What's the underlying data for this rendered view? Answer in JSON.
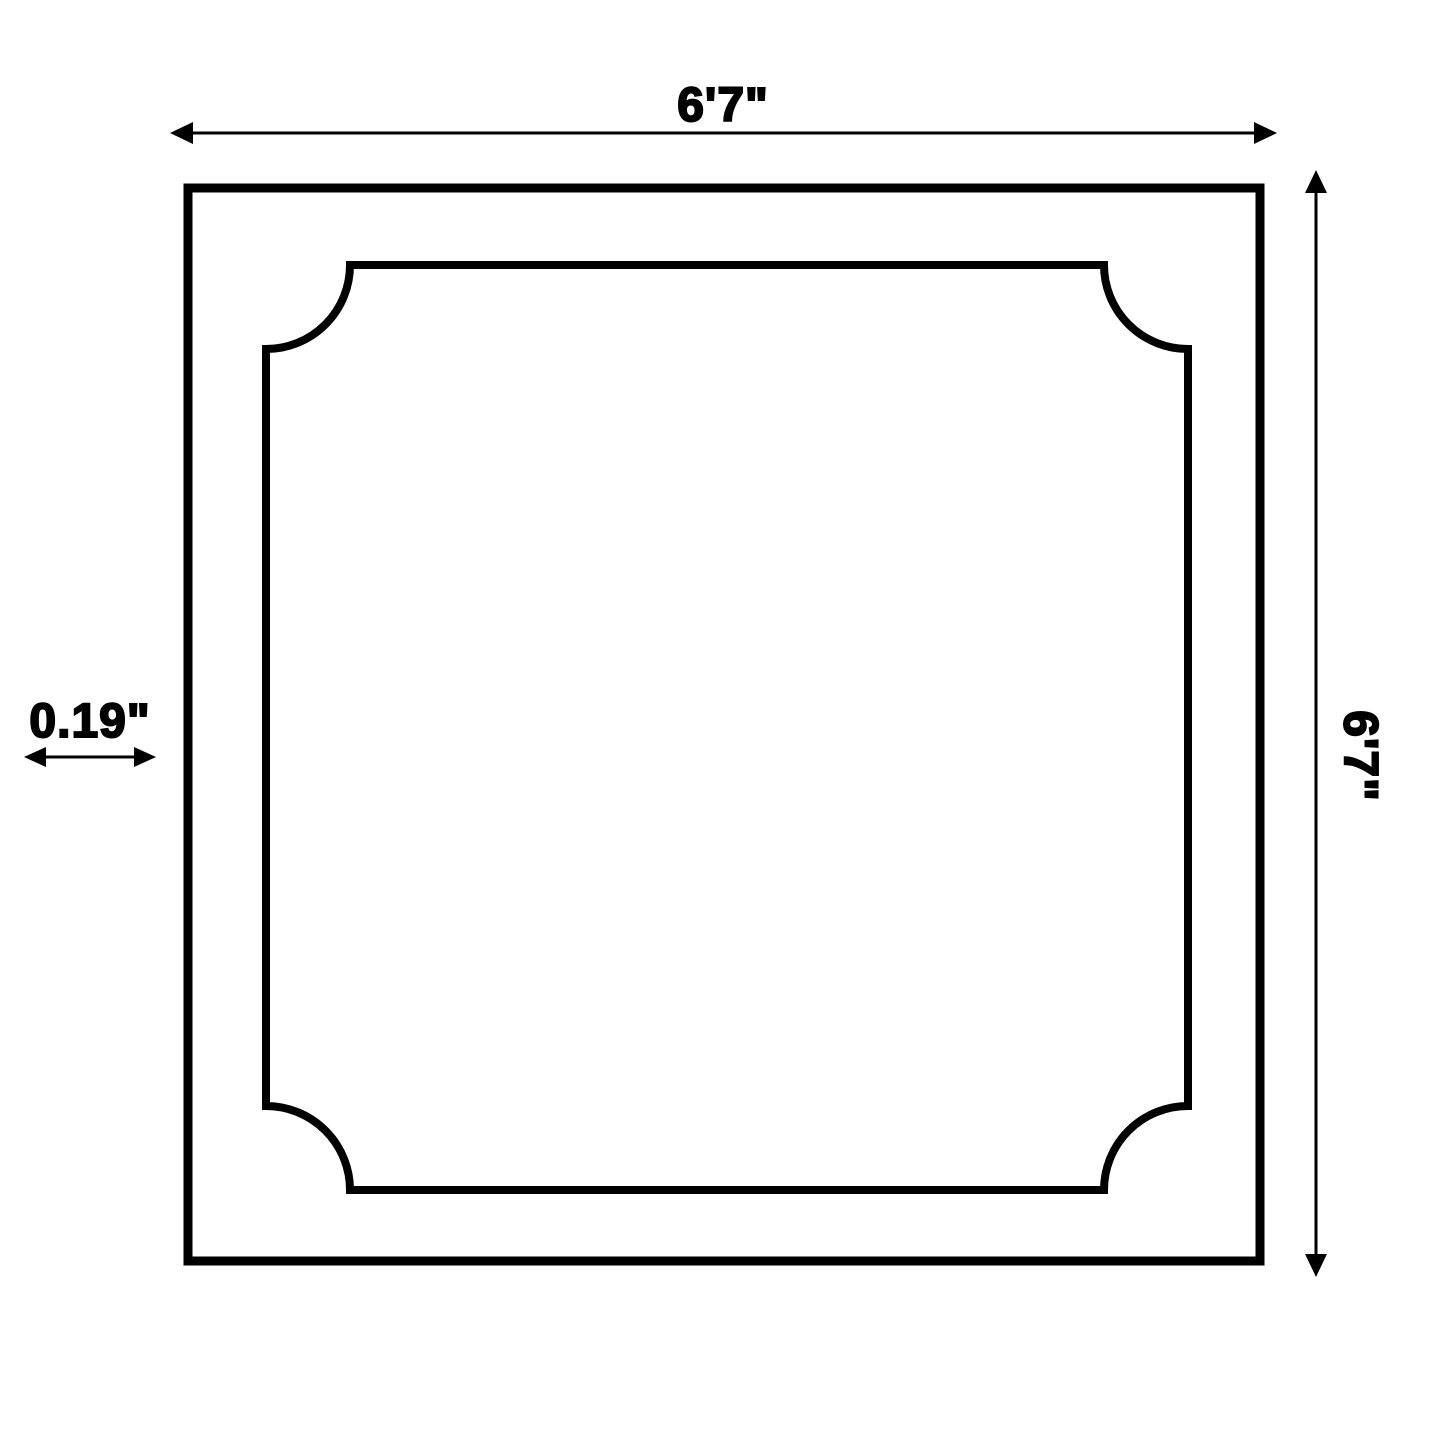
{
  "diagram": {
    "description": "Square frame dimension drawing with scalloped inner border",
    "background_color": "#ffffff",
    "line_color": "#000000",
    "dimensions": {
      "width_label": "6'7\"",
      "height_label": "6'7\"",
      "thickness_label": "0.19\""
    }
  }
}
